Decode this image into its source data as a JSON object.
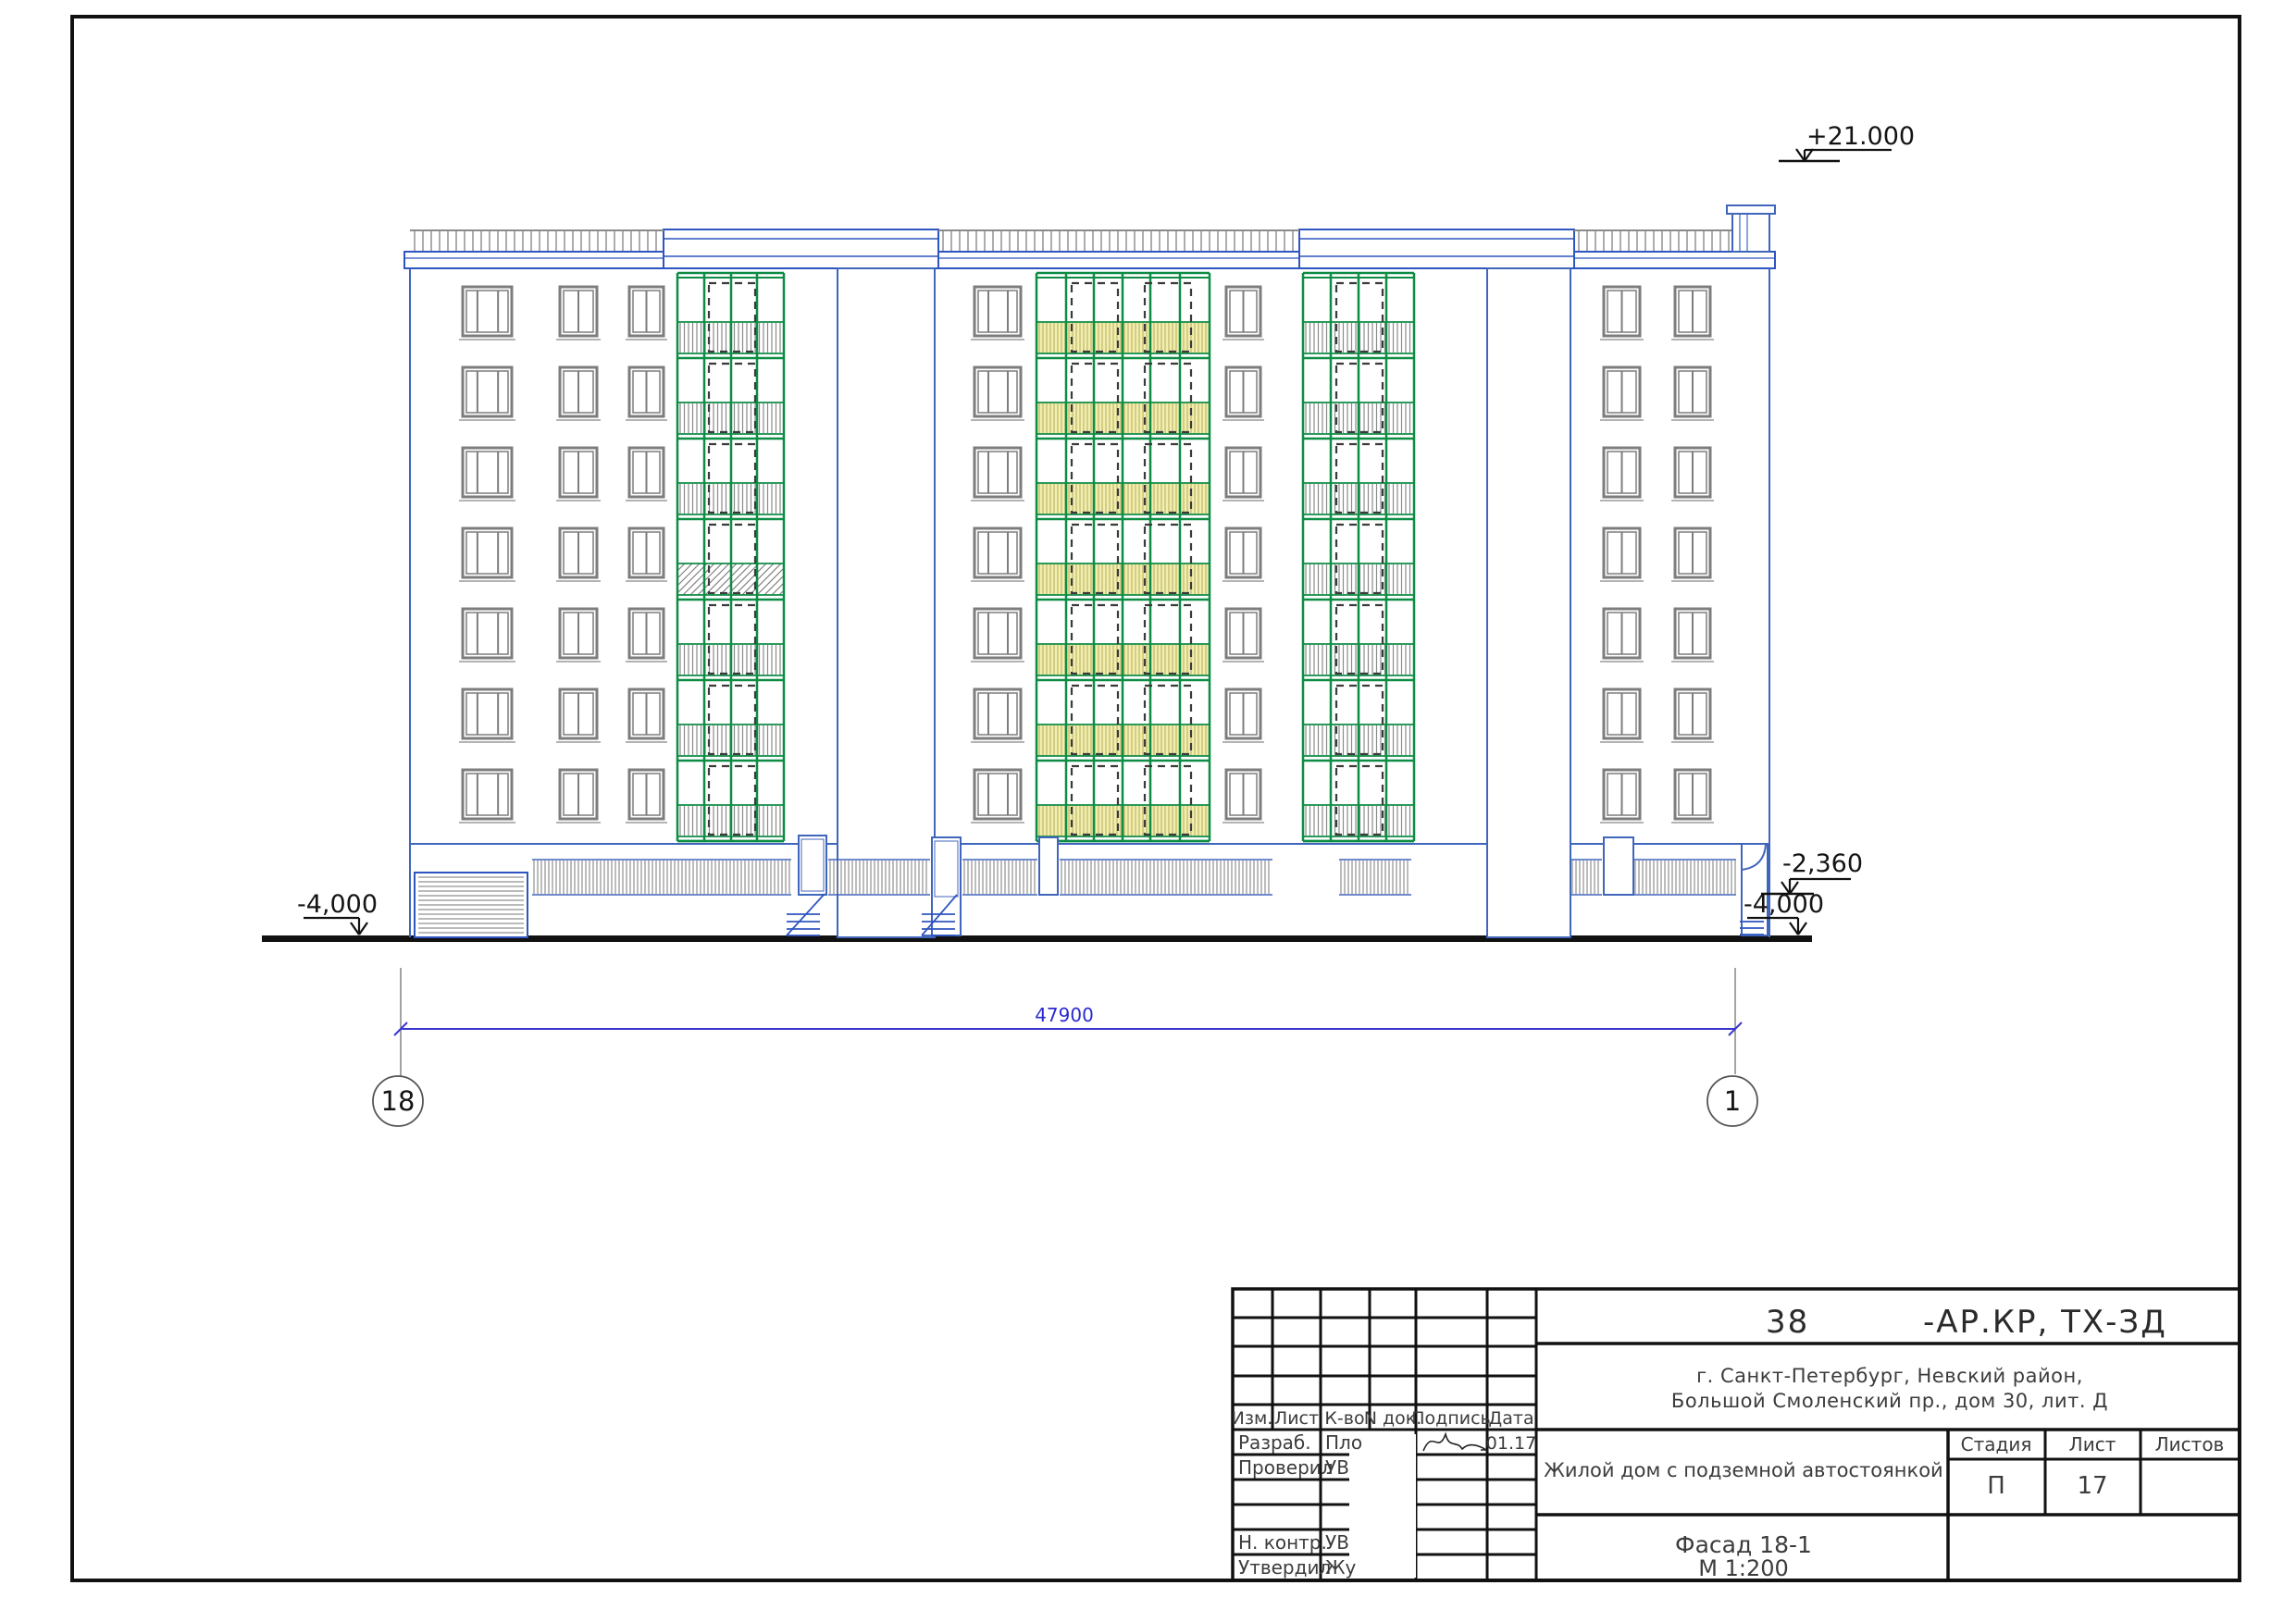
{
  "sheet": {
    "elevation_marks": {
      "roof": "+21.000",
      "mid_right": "-2,360",
      "ground_right": "-4,000",
      "ground_left": "-4,000"
    },
    "dimension": {
      "overall_width": "47900"
    },
    "axes": {
      "left": "18",
      "right": "1"
    }
  },
  "title_block": {
    "code_prefix": "38",
    "code_suffix": "-АР.КР,  ТХ-ЗД",
    "address_line1": "г. Санкт-Петербург,  Невский район,",
    "address_line2": "Большой Смоленский пр.,  дом 30,  лит.  Д",
    "project_name": "Жилой дом с подземной автостоянкой",
    "sheet_name": "Фасад 18-1",
    "scale": "М 1:200",
    "columns": {
      "izm": "Изм.",
      "list": "Лист",
      "kvo": "К-во",
      "ndok": "N док.",
      "podpis": "Подпись",
      "data": "Дата"
    },
    "stage_header": "Стадия",
    "sheet_header": "Лист",
    "sheets_header": "Листов",
    "stage": "П",
    "sheet_number": "17",
    "sheets_total": "",
    "date": "01.17",
    "rows": [
      {
        "role": "Разраб.",
        "name": "Пло"
      },
      {
        "role": "Проверил",
        "name": "УВ"
      },
      {
        "role": "Н. контр.",
        "name": "УВ"
      },
      {
        "role": "Утвердил",
        "name": "Жу"
      }
    ]
  },
  "colors": {
    "outline_blue": "#4066bb",
    "heavy_blue": "#2f55c0",
    "balcony_green": "#0d8c44",
    "balcony_yellow": "#f2eead",
    "yellow_line": "#b4ac62",
    "dimension_blue": "#3a35cf"
  }
}
